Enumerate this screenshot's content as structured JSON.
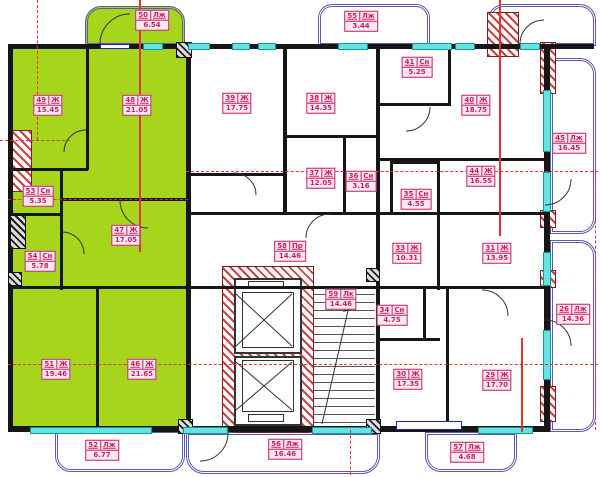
{
  "colors": {
    "apartment_highlight": "#a6d51b",
    "wall": "#161616",
    "window_glazing": "#66e2e2",
    "balcony_rail": "#5a5ab0",
    "axis_red": "#e23333",
    "hatch_red": "#c94343",
    "label_magenta": "#c7205f"
  },
  "rooms": [
    {
      "id": "50",
      "type": "Лж",
      "area": "6.54"
    },
    {
      "id": "49",
      "type": "Ж",
      "area": "15.45"
    },
    {
      "id": "48",
      "type": "Ж",
      "area": "21.05"
    },
    {
      "id": "53",
      "type": "Сн",
      "area": "5.35"
    },
    {
      "id": "54",
      "type": "Сн",
      "area": "5.78"
    },
    {
      "id": "47",
      "type": "Ж",
      "area": "17.05"
    },
    {
      "id": "51",
      "type": "Ж",
      "area": "19.46"
    },
    {
      "id": "46",
      "type": "Ж",
      "area": "21.65"
    },
    {
      "id": "52",
      "type": "Лж",
      "area": "6.77"
    },
    {
      "id": "39",
      "type": "Ж",
      "area": "17.75"
    },
    {
      "id": "38",
      "type": "Ж",
      "area": "14.35"
    },
    {
      "id": "37",
      "type": "Ж",
      "area": "12.05"
    },
    {
      "id": "36",
      "type": "Сн",
      "area": "3.16"
    },
    {
      "id": "35",
      "type": "Сн",
      "area": "4.55"
    },
    {
      "id": "41",
      "type": "Сн",
      "area": "5.25"
    },
    {
      "id": "40",
      "type": "Ж",
      "area": "18.75"
    },
    {
      "id": "44",
      "type": "Ж",
      "area": "16.55"
    },
    {
      "id": "45",
      "type": "Лж",
      "area": "16.45"
    },
    {
      "id": "33",
      "type": "Ж",
      "area": "10.31"
    },
    {
      "id": "31",
      "type": "Ж",
      "area": "13.95"
    },
    {
      "id": "58",
      "type": "Пр",
      "area": "14.46"
    },
    {
      "id": "59",
      "type": "Лк",
      "area": "14.46"
    },
    {
      "id": "34",
      "type": "Сн",
      "area": "4.75"
    },
    {
      "id": "30",
      "type": "Ж",
      "area": "17.35"
    },
    {
      "id": "29",
      "type": "Ж",
      "area": "17.70"
    },
    {
      "id": "26",
      "type": "Лж",
      "area": "14.36"
    },
    {
      "id": "55",
      "type": "Лж",
      "area": "3.44"
    },
    {
      "id": "57",
      "type": "Лж",
      "area": "4.68"
    },
    {
      "id": "56",
      "type": "Лж",
      "area": "16.46"
    }
  ]
}
